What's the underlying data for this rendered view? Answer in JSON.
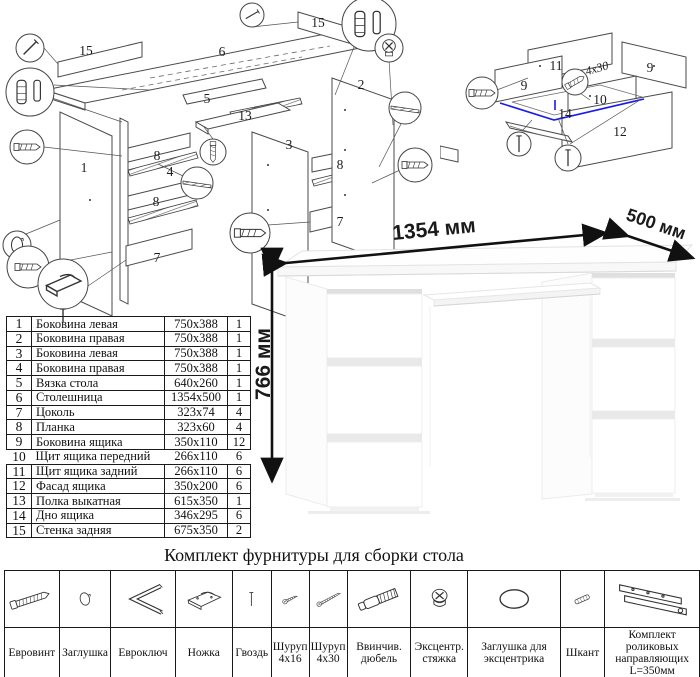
{
  "page": {
    "background": "#ffffff"
  },
  "assembly_diagram": {
    "name": "exploded-desk-assembly-scheme",
    "labels": [
      {
        "text": "15",
        "x": 86,
        "y": 55
      },
      {
        "text": "6",
        "x": 222,
        "y": 56
      },
      {
        "text": "15",
        "x": 318,
        "y": 27
      },
      {
        "text": "5",
        "x": 207,
        "y": 103
      },
      {
        "text": "2",
        "x": 361,
        "y": 89
      },
      {
        "text": "13",
        "x": 245,
        "y": 120
      },
      {
        "text": "3",
        "x": 289,
        "y": 149
      },
      {
        "text": "1",
        "x": 84,
        "y": 172
      },
      {
        "text": "8",
        "x": 157,
        "y": 160
      },
      {
        "text": "4",
        "x": 170,
        "y": 176
      },
      {
        "text": "8",
        "x": 156,
        "y": 206
      },
      {
        "text": "7",
        "x": 157,
        "y": 262
      },
      {
        "text": "8",
        "x": 340,
        "y": 169
      },
      {
        "text": "7",
        "x": 340,
        "y": 226
      }
    ]
  },
  "drawer_diagram": {
    "name": "exploded-drawer-assembly-scheme",
    "labels": [
      {
        "text": "11",
        "x": 116,
        "y": 70
      },
      {
        "text": "9",
        "x": 84,
        "y": 90
      },
      {
        "text": "9",
        "x": 210,
        "y": 72
      },
      {
        "text": "10",
        "x": 160,
        "y": 104
      },
      {
        "text": "14",
        "x": 125,
        "y": 118
      },
      {
        "text": "12",
        "x": 180,
        "y": 136
      }
    ],
    "annotation": "4x30",
    "highlight_color": "#1a1aee"
  },
  "parts_list": {
    "rows": [
      {
        "num": "1",
        "name": "Боковина левая",
        "size": "750x388",
        "qty": "1"
      },
      {
        "num": "2",
        "name": "Боковина правая",
        "size": "750x388",
        "qty": "1"
      },
      {
        "num": "3",
        "name": "Боковина левая",
        "size": "750x388",
        "qty": "1"
      },
      {
        "num": "4",
        "name": "Боковина правая",
        "size": "750x388",
        "qty": "1"
      },
      {
        "num": "5",
        "name": "Вязка стола",
        "size": "640x260",
        "qty": "1"
      },
      {
        "num": "6",
        "name": "Столешница",
        "size": "1354x500",
        "qty": "1"
      },
      {
        "num": "7",
        "name": "Цоколь",
        "size": "323x74",
        "qty": "4"
      },
      {
        "num": "8",
        "name": "Планка",
        "size": "323x60",
        "qty": "4"
      },
      {
        "num": "9",
        "name": "Боковина ящика",
        "size": "350x110",
        "qty": "12"
      },
      {
        "num": "10",
        "name": "Щит ящика передний",
        "size": "266x110",
        "qty": "6"
      },
      {
        "num": "11",
        "name": "Щит ящика задний",
        "size": "266x110",
        "qty": "6"
      },
      {
        "num": "12",
        "name": "Фасад ящика",
        "size": "350x200",
        "qty": "6"
      },
      {
        "num": "13",
        "name": "Полка выкатная",
        "size": "615x350",
        "qty": "1"
      },
      {
        "num": "14",
        "name": "Дно ящика",
        "size": "346x295",
        "qty": "6"
      },
      {
        "num": "15",
        "name": "Стенка задняя",
        "size": "675x350",
        "qty": "2"
      }
    ]
  },
  "desk": {
    "dimensions": {
      "width": "1354 мм",
      "depth": "500 мм",
      "height": "766 мм"
    }
  },
  "hardware": {
    "title": "Комплект фурнитуры для сборки стола",
    "items": [
      {
        "icon": "euroscrew-icon",
        "name": "Евровинт",
        "qty": "36"
      },
      {
        "icon": "plug-icon",
        "name": "Заглушка",
        "qty": "8"
      },
      {
        "icon": "hexkey-icon",
        "name": "Евроключ",
        "qty": "1"
      },
      {
        "icon": "foot-icon",
        "name": "Ножка",
        "qty": "8"
      },
      {
        "icon": "nail-icon",
        "name": "Гвоздь",
        "qty": "50"
      },
      {
        "icon": "screw-small-icon",
        "name": "Шуруп 4x16",
        "qty": "56"
      },
      {
        "icon": "screw-long-icon",
        "name": "Шуруп 4x30",
        "qty": "12"
      },
      {
        "icon": "dowel-icon",
        "name": "Ввинчив. дюбель",
        "qty": "8"
      },
      {
        "icon": "eccentric-icon",
        "name": "Эксцентр. стяжка",
        "qty": "8"
      },
      {
        "icon": "eccentric-cover-icon",
        "name": "Заглушка для эксцентрика",
        "qty": "8"
      },
      {
        "icon": "shkant-icon",
        "name": "Шкант",
        "qty": "24"
      },
      {
        "icon": "slides-icon",
        "name": "Комплект роликовых направляющих L=350мм",
        "qty": "7"
      }
    ]
  }
}
